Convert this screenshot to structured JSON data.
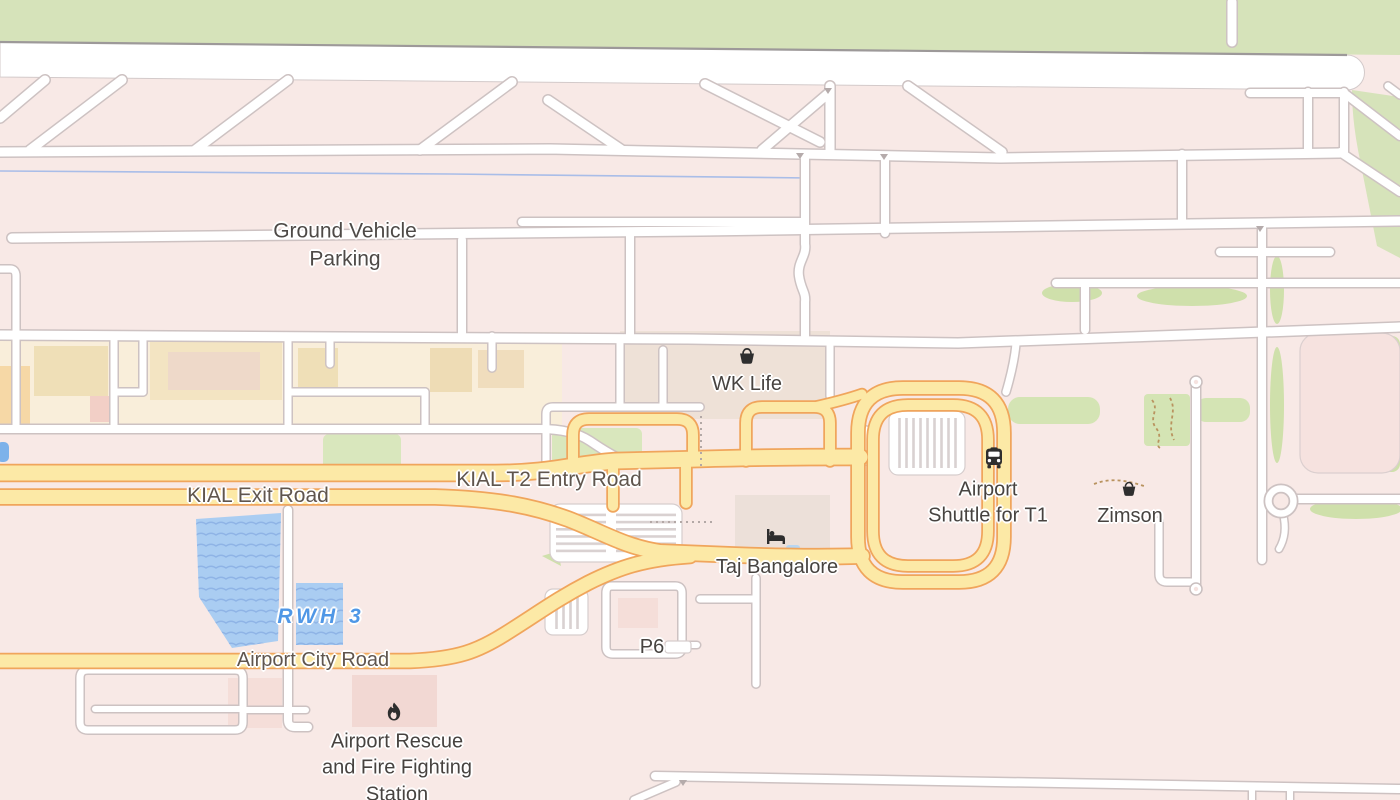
{
  "map_labels": {
    "ground_vehicle_parking": "Ground Vehicle\nParking",
    "wk_life": "WK Life",
    "kial_t2_entry_road": "KIAL T2 Entry Road",
    "kial_exit_road": "KIAL Exit Road",
    "airport_shuttle": "Airport\nShuttle for T1",
    "zimson": "Zimson",
    "taj_bangalore": "Taj Bangalore",
    "rwh_3": "RWH 3",
    "airport_city_road": "Airport City Road",
    "p6": "P6",
    "fire_station": "Airport Rescue\nand Fire Fighting\nStation"
  },
  "poi_icons": {
    "wk_life": "shopping-basket-icon",
    "zimson": "shopping-basket-icon",
    "airport_shuttle": "bus-icon",
    "taj_bangalore": "hotel-bed-icon",
    "fire_station": "fire-icon"
  },
  "colors": {
    "background": "#f8e9e6",
    "greenery": "#d6e3ba",
    "road_fill": "#ffffff",
    "road_casing": "#cdc2c2",
    "highway_fill": "#fce9a6",
    "highway_casing": "#f0a55c",
    "water": "#aacdf2",
    "water_label": "#4f97e6",
    "poi_label": "#474340",
    "road_label": "#60564e",
    "icon_color": "#2e2e2e"
  }
}
